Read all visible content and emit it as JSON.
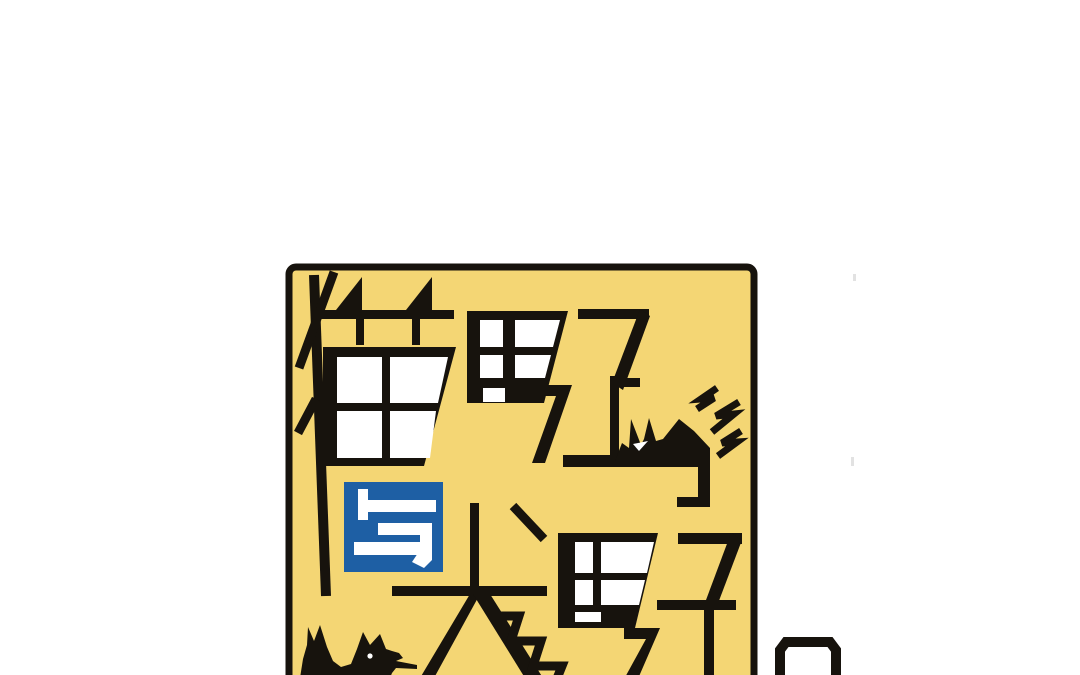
{
  "page": {
    "background_color": "#FFFFFF"
  },
  "cover": {
    "title": "猫男子与犬男子",
    "rows": {
      "top": "猫男子",
      "middle": "与",
      "bottom": "犬男子"
    },
    "glyphs": {
      "mao": "猫",
      "nan": "男",
      "zi": "子",
      "yu": "与",
      "quan": "犬"
    },
    "icons": [
      "cat-silhouette",
      "dog-silhouette",
      "lightning-sparks",
      "window-panes",
      "partial-panel-box"
    ],
    "colors": {
      "card_yellow": "#F4D674",
      "connector_blue": "#1E5FA4",
      "ink_black": "#17130D",
      "pane_white": "#FFFFFF",
      "artifact_gray": "#E2E2E2"
    }
  }
}
